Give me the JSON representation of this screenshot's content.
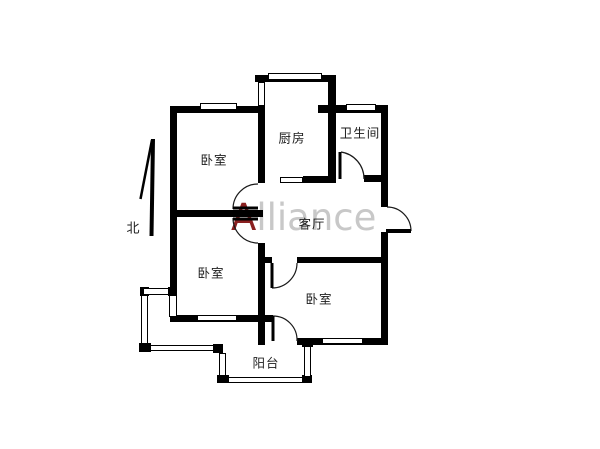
{
  "title": "apartment-floor-plan",
  "watermark": {
    "letter_a": "A",
    "letters_rest": "lliance",
    "color_a": "#8b2020",
    "color_rest": "#c8c8c8"
  },
  "compass": {
    "label": "北"
  },
  "rooms": {
    "bedroom_top_left": {
      "label": "卧室"
    },
    "bedroom_bottom_left": {
      "label": "卧室"
    },
    "bedroom_bottom_right": {
      "label": "卧室"
    },
    "kitchen": {
      "label": "厨房"
    },
    "bathroom": {
      "label": "卫生间"
    },
    "living_room": {
      "label": "客厅"
    },
    "balcony": {
      "label": "阳台"
    }
  },
  "colors": {
    "wall": "#000000",
    "background": "#ffffff",
    "door_line": "#1a1a1a"
  }
}
